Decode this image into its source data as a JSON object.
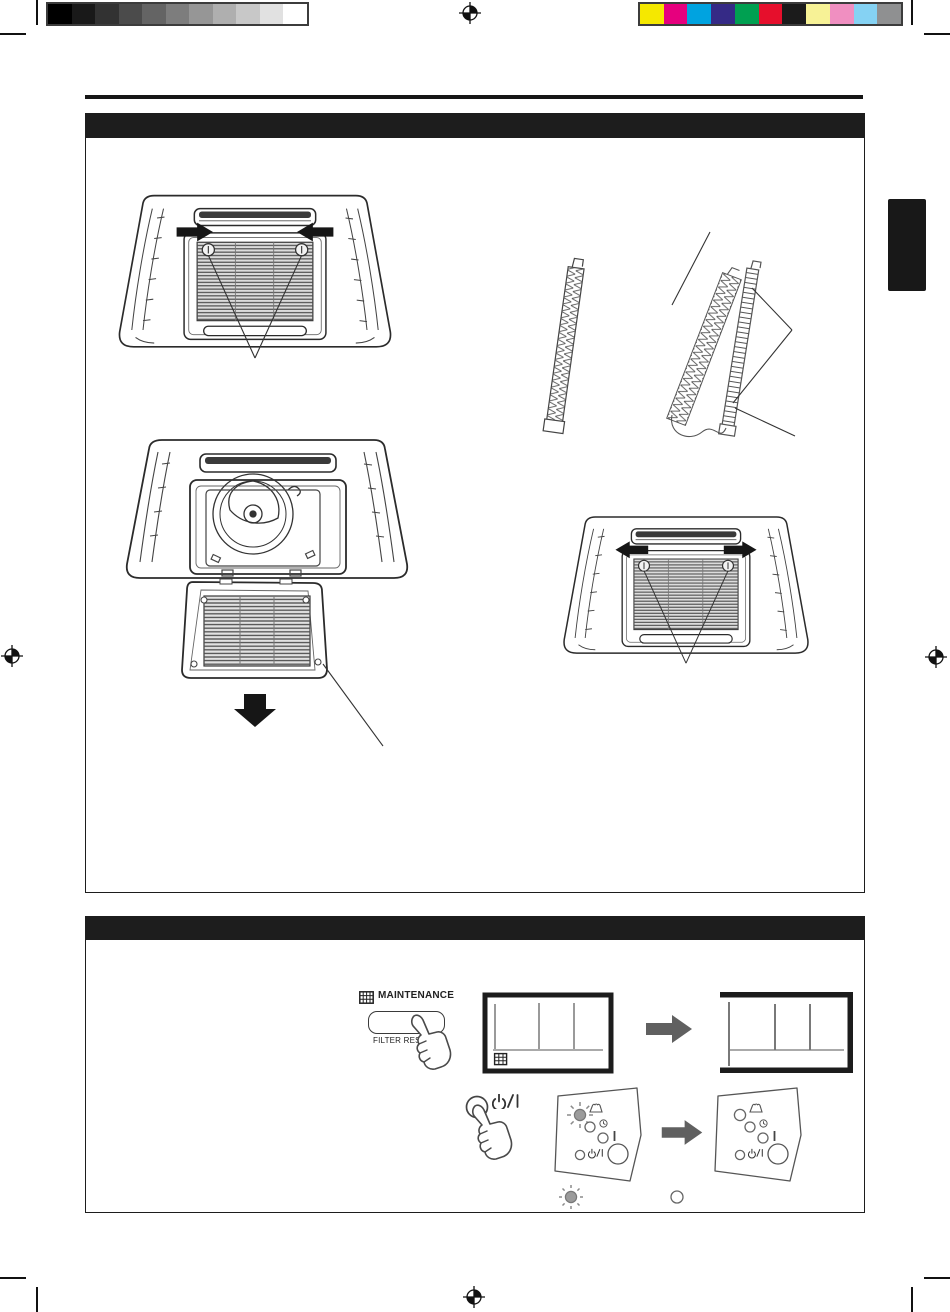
{
  "document": {
    "kind": "scanned appliance manual page (ceiling cassette air conditioner filter maintenance)",
    "page_bg": "#ffffff",
    "ink": "#1d1d1d"
  },
  "print_marks": {
    "grayscale_bar": [
      "#000000",
      "#191919",
      "#323232",
      "#4b4b4b",
      "#646464",
      "#7d7d7d",
      "#969696",
      "#afafaf",
      "#c8c8c8",
      "#e1e1e1",
      "#ffffff"
    ],
    "color_bar": [
      "#f5e800",
      "#e6007e",
      "#00a3e0",
      "#352a86",
      "#00a051",
      "#e60f2c",
      "#1b1b1b",
      "#f7f296",
      "#f08fc1",
      "#85d2f3",
      "#8f9091"
    ]
  },
  "section_filter_removal": {
    "header_label": ""
  },
  "section_filter_reset": {
    "header_label": ""
  },
  "side_tab": {
    "label": ""
  },
  "reset_controls": {
    "maintenance_label": "MAINTENANCE",
    "filter_reset_label": "FILTER RESET",
    "power_label": "⏻/I",
    "operation_label": "I",
    "arrow_color": "#606060"
  }
}
